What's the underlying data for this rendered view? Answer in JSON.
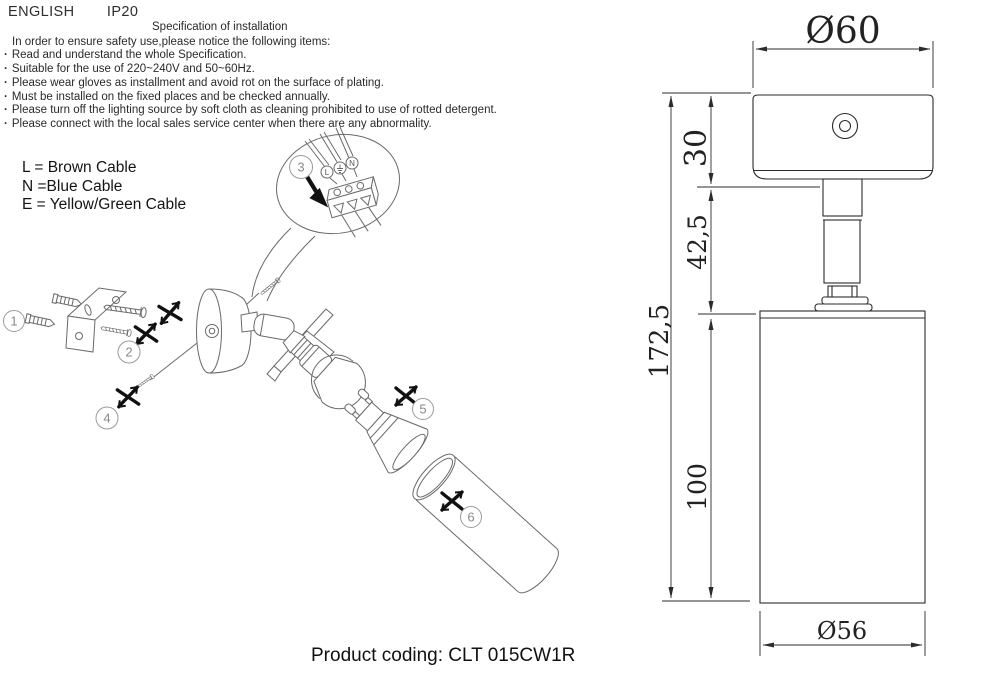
{
  "header": {
    "language": "ENGLISH",
    "ip_rating": "IP20"
  },
  "spec": {
    "title": "Specification of installation",
    "intro": "In order to ensure safety use,please notice the following items:",
    "items": [
      "Read and understand the whole Specification.",
      "Suitable for the use of 220~240V and 50~60Hz.",
      "Please wear gloves as installment and avoid rot on the surface of plating.",
      "Must be installed on the fixed places and be checked annually.",
      "Please turn off the lighting source by soft cloth as cleaning prohibited to use of rotted detergent.",
      "Please connect with the local sales service center when there are any abnormality."
    ]
  },
  "legend": {
    "line1": "L = Brown Cable",
    "line2": "N =Blue Cable",
    "line3": "E = Yellow/Green Cable"
  },
  "callout": {
    "part_number": "3",
    "terminal_left": "L",
    "terminal_right": "N"
  },
  "parts": {
    "p1": "1",
    "p2": "2",
    "p4": "4",
    "p5": "5",
    "p6": "6"
  },
  "dimensions": {
    "top_diameter": "Ø60",
    "canopy_height": "30",
    "stem_height": "42,5",
    "overall_height": "172,5",
    "body_height": "100",
    "body_diameter": "Ø56"
  },
  "footer": {
    "product_coding": "Product coding: CLT 015CW1R"
  },
  "colors": {
    "ink": "#2b2b2b",
    "line_art": "#6a6a6a",
    "marker_black": "#111111"
  }
}
